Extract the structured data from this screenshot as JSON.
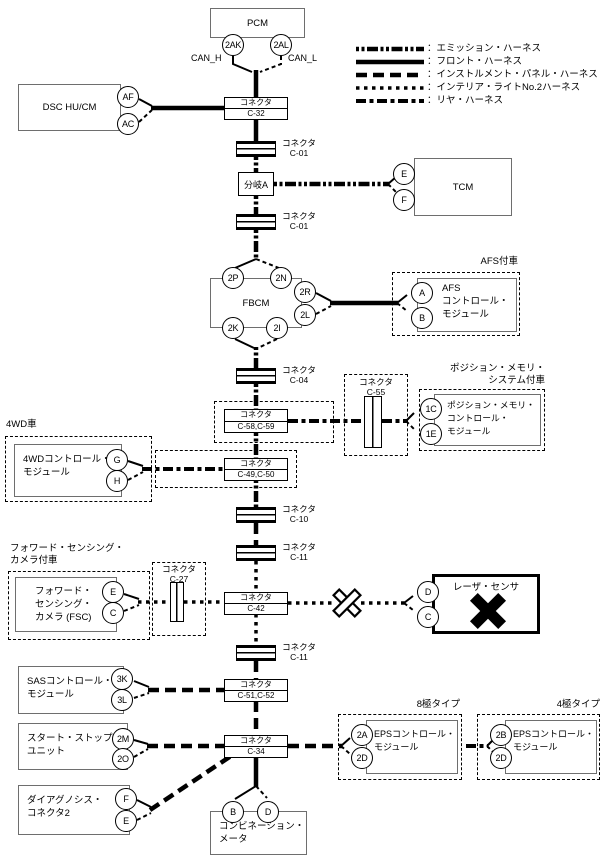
{
  "legend": {
    "items": [
      {
        "label": "：エミッション・ハーネス",
        "style": "emission"
      },
      {
        "label": "：フロント・ハーネス",
        "style": "solid"
      },
      {
        "label": "：インストルメント・パネル・ハーネス",
        "style": "longdash"
      },
      {
        "label": "：インテリア・ライトNo.2ハーネス",
        "style": "dots"
      },
      {
        "label": "：リヤ・ハーネス",
        "style": "dashdot"
      }
    ]
  },
  "bus": {
    "can_h": "CAN_H",
    "can_l": "CAN_L"
  },
  "connectors": {
    "c32": [
      "コネクタ",
      "C-32"
    ],
    "c01a": [
      "コネクタ",
      "C-01"
    ],
    "c01b": [
      "コネクタ",
      "C-01"
    ],
    "c04": [
      "コネクタ",
      "C-04"
    ],
    "c55": [
      "コネクタ",
      "C-55"
    ],
    "c5859": [
      "コネクタ",
      "C-58,C-59"
    ],
    "c4950": [
      "コネクタ",
      "C-49,C-50"
    ],
    "c10": [
      "コネクタ",
      "C-10"
    ],
    "c11a": [
      "コネクタ",
      "C-11"
    ],
    "c27": [
      "コネクタ",
      "C-27"
    ],
    "c42": [
      "コネクタ",
      "C-42"
    ],
    "c11b": [
      "コネクタ",
      "C-11"
    ],
    "c5152": [
      "コネクタ",
      "C-51,C-52"
    ],
    "c34": [
      "コネクタ",
      "C-34"
    ],
    "branch_a": "分岐A"
  },
  "groups": {
    "afs": "AFS付車",
    "posmem": [
      "ポジション・メモリ・",
      "システム付車"
    ],
    "awd": "4WD車",
    "fsc": [
      "フォワード・センシング・",
      "カメラ付車"
    ],
    "eps8": "8極タイプ",
    "eps4": "4極タイプ"
  },
  "modules": {
    "pcm": {
      "name": "PCM",
      "pins": [
        "2AK",
        "2AL"
      ]
    },
    "dsc": {
      "name": "DSC HU/CM",
      "pins": [
        "AF",
        "AC"
      ]
    },
    "tcm": {
      "name": "TCM",
      "pins": [
        "E",
        "F"
      ]
    },
    "fbcm": {
      "name": "FBCM",
      "pins": [
        "2P",
        "2N",
        "2R",
        "2L",
        "2K",
        "2I"
      ]
    },
    "afs": {
      "lines": [
        "AFS",
        "コントロール・",
        "モジュール"
      ],
      "pins": [
        "A",
        "B"
      ]
    },
    "posmem": {
      "lines": [
        "ポジション・メモリ・",
        "コントロール・",
        "モジュール"
      ],
      "pins": [
        "1C",
        "1E"
      ]
    },
    "awd": {
      "lines": [
        "4WDコントロール・",
        "モジュール"
      ],
      "pins": [
        "G",
        "H"
      ]
    },
    "fsc": {
      "lines": [
        "フォワード・",
        "センシング・",
        "カメラ (FSC)"
      ],
      "pins": [
        "E",
        "C"
      ]
    },
    "laser": {
      "name": "レーザ・センサ",
      "pins": [
        "D",
        "C"
      ]
    },
    "sas": {
      "lines": [
        "SASコントロール・",
        "モジュール"
      ],
      "pins": [
        "3K",
        "3L"
      ]
    },
    "startstop": {
      "lines": [
        "スタート・ストップ・",
        "ユニット"
      ],
      "pins": [
        "2M",
        "2O"
      ]
    },
    "eps8": {
      "lines": [
        "EPSコントロール・",
        "モジュール"
      ],
      "pins": [
        "2A",
        "2D"
      ]
    },
    "eps4": {
      "lines": [
        "EPSコントロール・",
        "モジュール"
      ],
      "pins": [
        "2B",
        "2D"
      ]
    },
    "diag": {
      "lines": [
        "ダイアグノシス・",
        "コネクタ2"
      ],
      "pins": [
        "F",
        "E"
      ]
    },
    "meter": {
      "lines": [
        "コンビネーション・",
        "メータ"
      ],
      "pins": [
        "B",
        "D"
      ]
    }
  }
}
